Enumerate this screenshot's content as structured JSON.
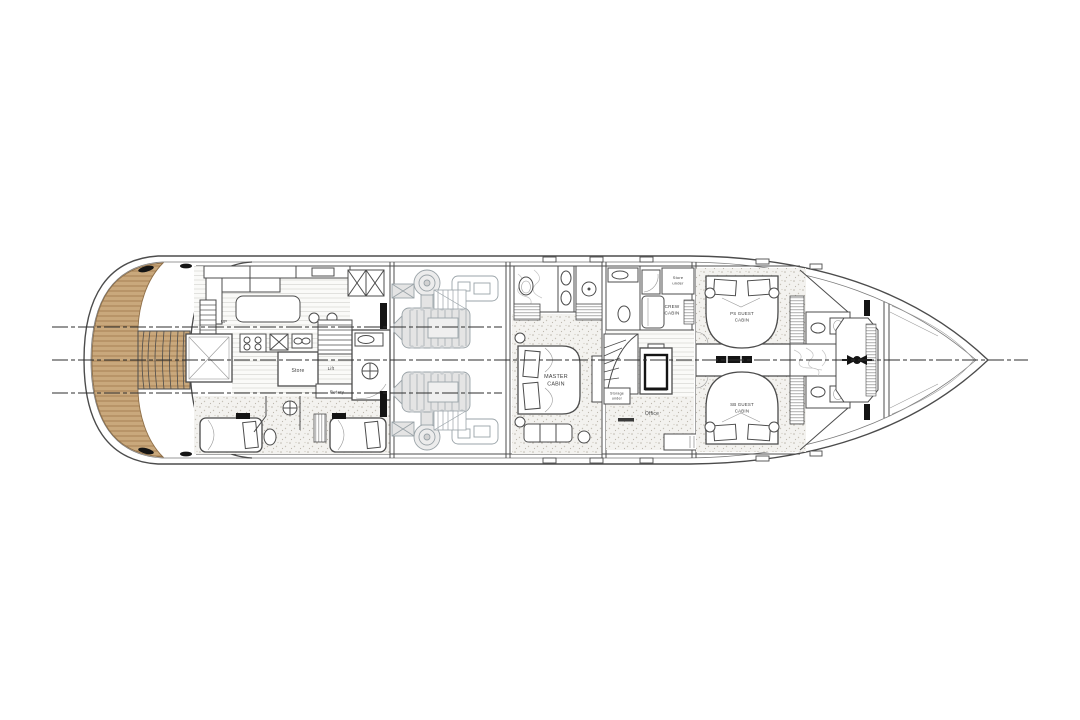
{
  "plan": {
    "labels": {
      "master_cabin": {
        "line1": "MASTER",
        "line2": "CABIN"
      },
      "crew_cabin": {
        "line1": "CREW",
        "line2": "CABIN"
      },
      "ps_guest_cabin": {
        "line1": "PS GUEST",
        "line2": "CABIN"
      },
      "sb_guest_cabin": {
        "line1": "SB GUEST",
        "line2": "CABIN"
      },
      "office": "Office",
      "store": "Store",
      "lift": "Lift",
      "rotary": "Rotary",
      "store_under": {
        "line1": "Store",
        "line2": "under"
      },
      "storage_under": {
        "line1": "Storage",
        "line2": "under"
      },
      "up": "UP"
    },
    "colors": {
      "background": "#ffffff",
      "line": "#4c4c4c",
      "teak_fill": "#c9a87c",
      "teak_plank_line": "#9a7447",
      "engine_gray": "#9aa3a8",
      "carpet_dot": "#bdb8ae"
    }
  }
}
